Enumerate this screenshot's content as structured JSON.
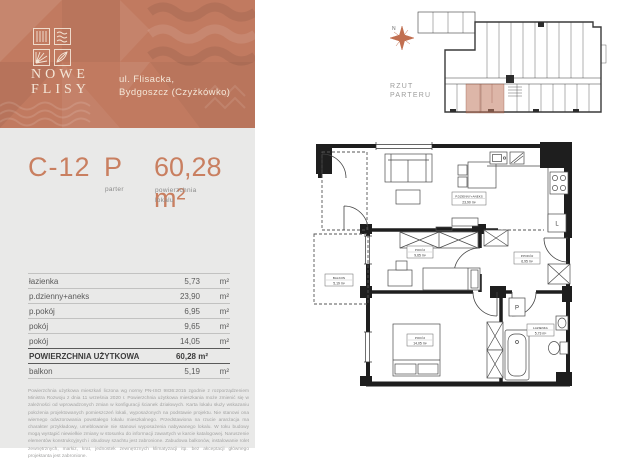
{
  "branding": {
    "name_line1": "NOWE",
    "name_line2": "FLISY",
    "address_line1": "ul. Flisacka,",
    "address_line2": "Bydgoszcz (Czyżkówko)"
  },
  "unit": {
    "code": "C-12",
    "floor_code": "P",
    "floor_label": "parter",
    "area_value": "60,28 m²",
    "area_label_line1": "powierzchnia",
    "area_label_line2": "lokalu"
  },
  "rooms": [
    {
      "name": "łazienka",
      "value": "5,73",
      "unit": "m²"
    },
    {
      "name": "p.dzienny+aneks",
      "value": "23,90",
      "unit": "m²"
    },
    {
      "name": "p.pokój",
      "value": "6,95",
      "unit": "m²"
    },
    {
      "name": "pokój",
      "value": "9,65",
      "unit": "m²"
    },
    {
      "name": "pokój",
      "value": "14,05",
      "unit": "m²"
    }
  ],
  "total": {
    "name": "POWIERZCHNIA UŻYTKOWA",
    "value": "60,28 m²"
  },
  "extra": {
    "name": "balkon",
    "value": "5,19",
    "unit": "m²"
  },
  "disclaimer": "Powierzchnia użytkowa mieszkań liczona wg normy PN-ISO 9836:2015 zgodnie z rozporządzeniem Ministra Rozwoju z dnia 11 września 2020 r. Powierzchnia użytkowa mieszkania może zmienić się w zależności od wprowadzonych zmian w konfiguracji ścianek działowych. Karta lokalu służy wskazaniu położenia projektowanych pomieszczeń lokali, wyposażonych na podstawie projektu. Nie stanowi ona wiernego odwzorowania powstałego lokalu mieszkalnego. Przedstawiona na rzucie aranżacja ma charakter przykładowy, umeblowanie nie stanowi wyposażenia nabywanego lokalu. W toku budowy mogą wystąpić niewielkie zmiany w stosunku do informacji zawartych w karcie katalogowej. Naruszenie elementów konstrukcyjnych i obudowy szachtu jest zabronione. Zabudowa balkonów, instalowanie rolet zewnętrznych, markiz, krat, jednostek zewnętrznych klimatyzacji itp. bez akceptacji głównego projektanta jest zabronione.",
  "siteplan": {
    "caption_line1": "RZUT",
    "caption_line2": "PARTERU",
    "north_label": "N"
  },
  "floorplan": {
    "labels": [
      {
        "name": "P.DZIENNY+ANEKS",
        "area": "23,90 m²"
      },
      {
        "name": "POKÓJ",
        "area": "9,65 m²"
      },
      {
        "name": "P.POKÓJ",
        "area": "6,95 m²"
      },
      {
        "name": "POKÓJ",
        "area": "14,05 m²"
      },
      {
        "name": "ŁAZIENKA",
        "area": "5,73 m²"
      },
      {
        "name": "BALKON",
        "area": "5,19 m²"
      }
    ],
    "fridge_label": "L",
    "washer_label": "P"
  },
  "colors": {
    "banner": "#c17a60",
    "accent": "#c97f60",
    "panel_bg": "#e9e9e8",
    "cream_text": "#f4e6d7",
    "plan_line": "#222222",
    "highlight_unit": "#c17a60"
  }
}
